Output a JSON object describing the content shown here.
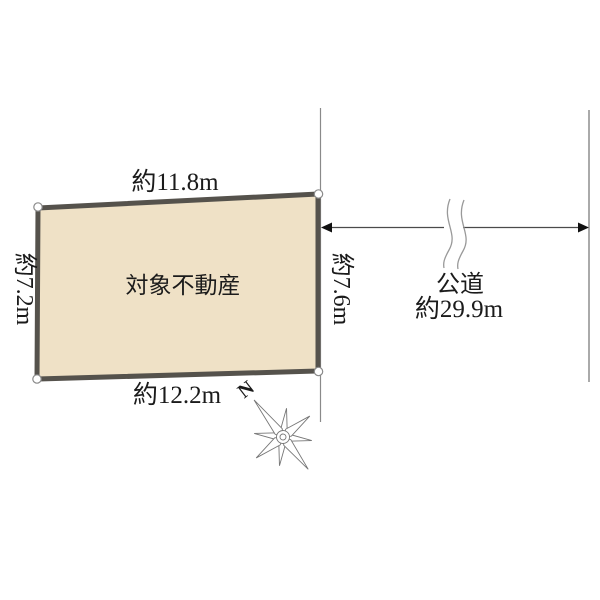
{
  "diagram": {
    "property": {
      "name": "対象不動産",
      "edge_top": "約11.8m",
      "edge_left": "約7.2m",
      "edge_right": "約7.6m",
      "edge_bottom": "約12.2m"
    },
    "road": {
      "name": "公道",
      "length": "約29.9m"
    },
    "compass": {
      "north_label": "N"
    },
    "icons": {
      "compass": "compass-rose-icon",
      "break_mark": "break-mark-icon",
      "corner_marker": "survey-point-marker"
    },
    "colors": {
      "property_fill": "#efe1c6",
      "property_border": "#55524c",
      "marker_fill": "#ffffff",
      "thin_line_gray": "#8a8a8a",
      "road_far_edge_gray": "#aaaaaa",
      "arrow_black": "#111111",
      "text_color": "#1b1b1b"
    }
  }
}
